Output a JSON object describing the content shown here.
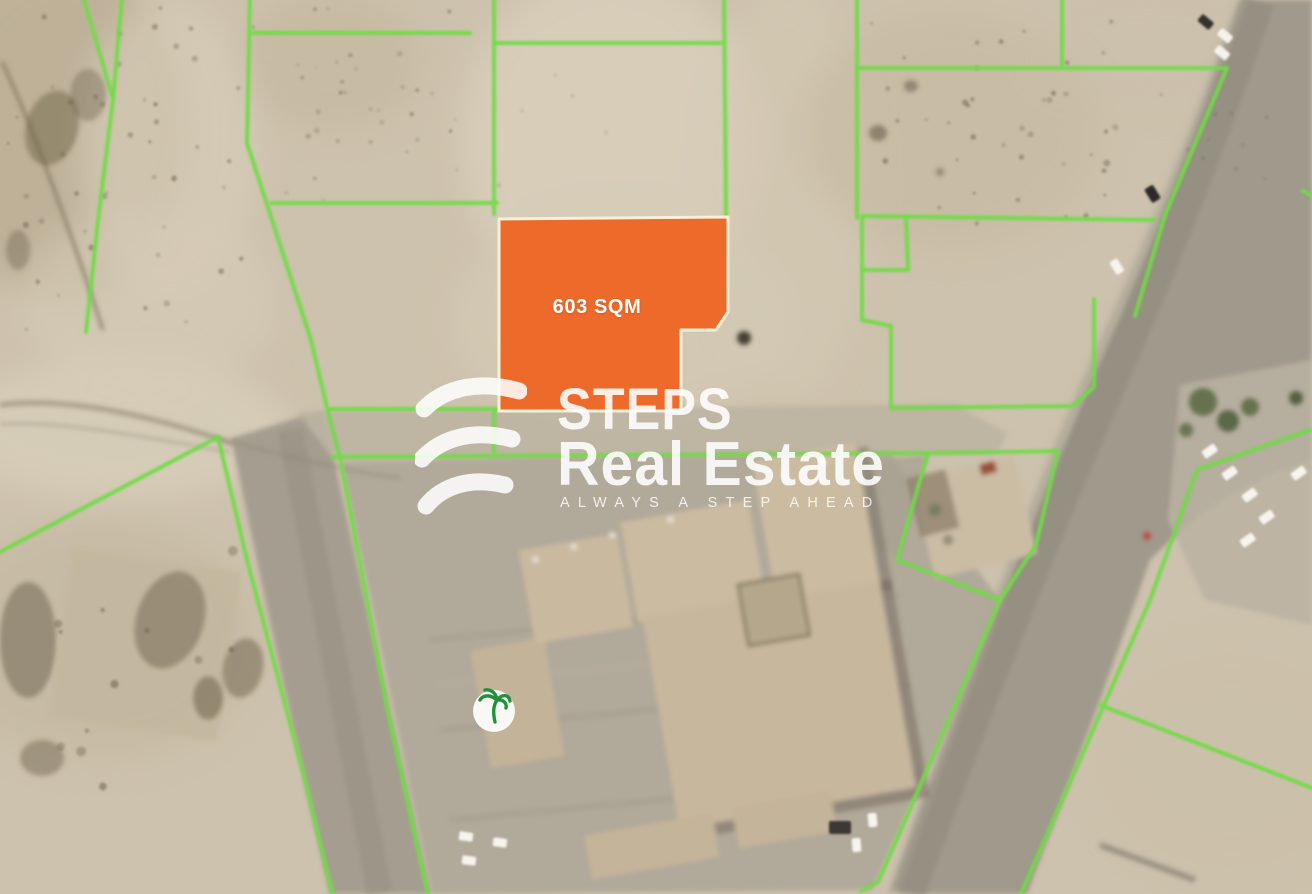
{
  "map_overlay": {
    "highlighted_plot": {
      "area_label": "603 SQM",
      "fill_color": "#ED6A2B",
      "border_color": "#F7F0D8"
    },
    "parcel_line_color": "#6FDC45",
    "landmark_marker": "palm-tree"
  },
  "watermark": {
    "brand_line1": "STEPS",
    "brand_line2": "Real Estate",
    "tagline": "ALWAYS A STEP AHEAD"
  }
}
